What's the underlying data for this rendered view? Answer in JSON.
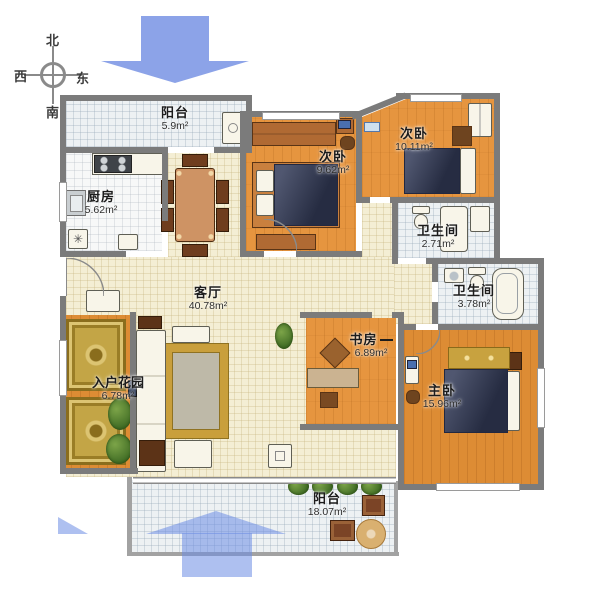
{
  "compass": {
    "north": "北",
    "west": "西",
    "east": "东",
    "south": "南"
  },
  "rooms": {
    "balcony_top": {
      "name": "阳台",
      "area": "5.9m²"
    },
    "kitchen": {
      "name": "厨房",
      "area": "5.62m²"
    },
    "bedroom_left": {
      "name": "次卧",
      "area": "9.62m²"
    },
    "bedroom_right": {
      "name": "次卧",
      "area": "10.11m²"
    },
    "bathroom_small": {
      "name": "卫生间",
      "area": "2.71m²"
    },
    "bathroom_large": {
      "name": "卫生间",
      "area": "3.78m²"
    },
    "living": {
      "name": "客厅",
      "area": "40.78m²"
    },
    "study": {
      "name": "书房",
      "area": "6.89m²"
    },
    "master": {
      "name": "主卧",
      "area": "15.96m²"
    },
    "garden": {
      "name": "入户花园",
      "area": "6.78m²"
    },
    "balcony_bottom": {
      "name": "阳台",
      "area": "18.07m²"
    }
  },
  "icons": {
    "floor_drain": "✳"
  },
  "colors": {
    "wall": "#7b7b7b",
    "wood_floor": "#e6953f",
    "cream_floor": "#f4eed4",
    "tile_floor": "#edf1f3",
    "arrow_blue": "#8ca3e8",
    "bed_navy": "#333b58",
    "rug_gold": "#c99f3c"
  }
}
